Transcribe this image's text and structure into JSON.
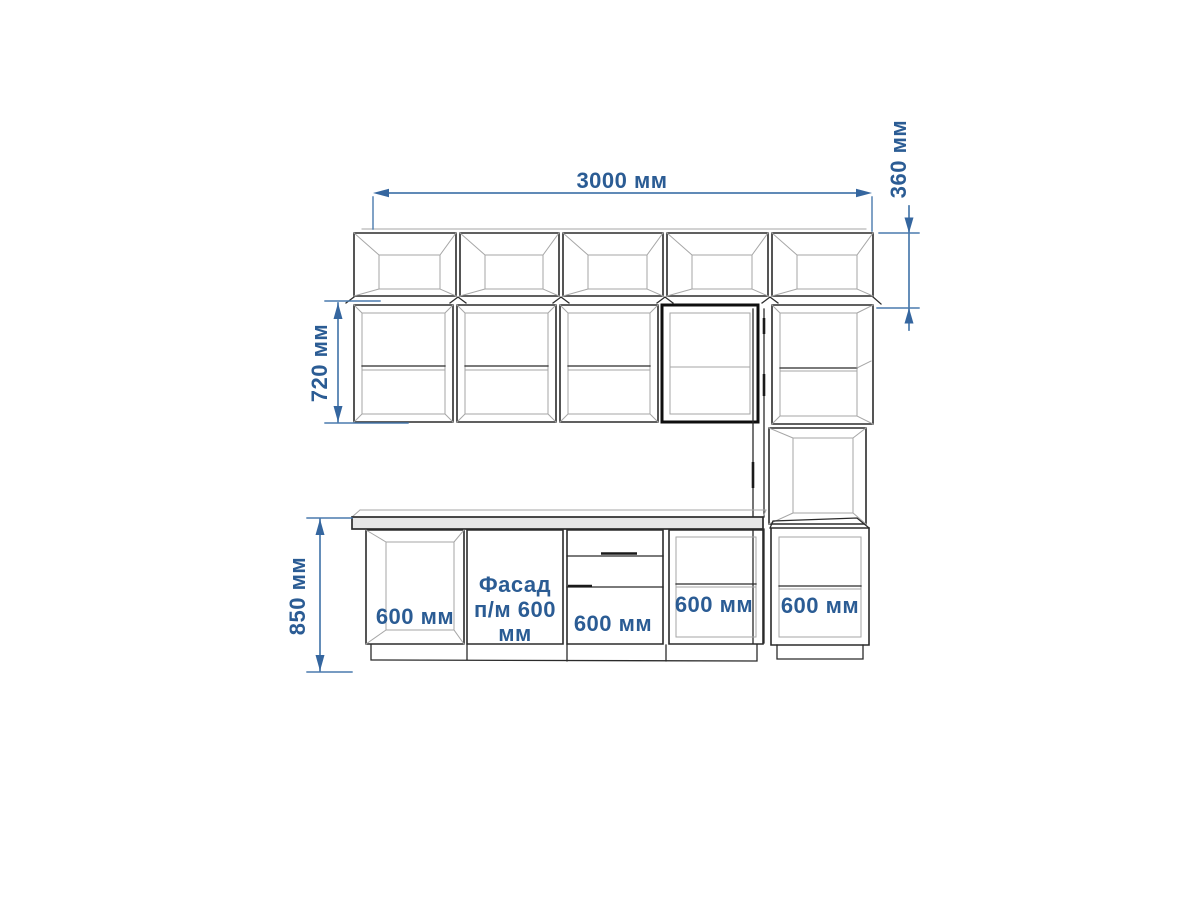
{
  "drawing": {
    "type": "kitchen-elevation-drawing",
    "colors": {
      "background": "#ffffff",
      "dimension_text": "#2b5c94",
      "dimension_line": "#4a7aad",
      "arrow": "#35669f",
      "outline": "#2b2b2b",
      "outline_bold": "#0f0f0f",
      "inner_line": "#a6a6a6",
      "countertop_fill": "#e6e6e6"
    },
    "dimensions": {
      "total_width": "3000 мм",
      "top_cabinet_height": "360 мм",
      "wall_cabinet_height": "720 мм",
      "base_cabinet_height": "850 мм"
    },
    "base_cabinets": {
      "cabinet_1": "600 мм",
      "facade_line_1": "Фасад",
      "facade_line_2": "п/м 600",
      "facade_line_3": "мм",
      "cabinet_3": "600 мм",
      "cabinet_4": "600 мм",
      "tall_cabinet": "600 мм"
    }
  }
}
